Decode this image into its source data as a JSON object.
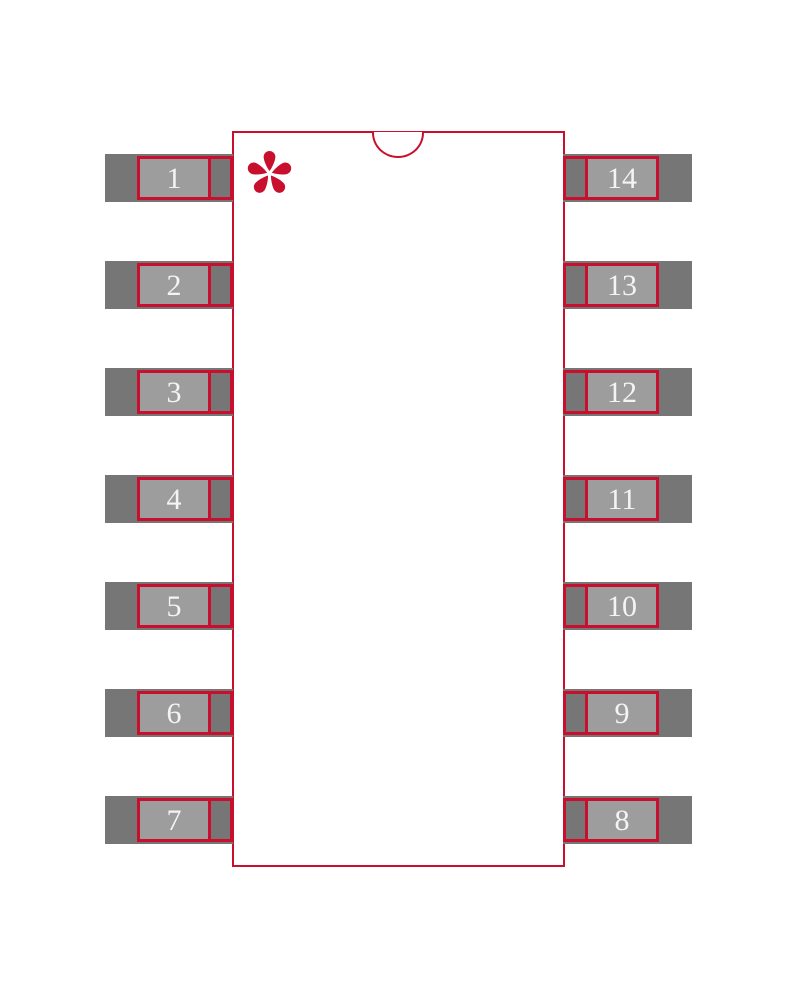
{
  "diagram": {
    "kind": "pcb-footprint-land-pattern",
    "package_style": "14-pin dual-row (SOIC-14)",
    "pin1_marker": "asterisk",
    "notch": "top-center semicircle"
  },
  "colors": {
    "accent_red": "#c8102e",
    "pad_dark": "#767676",
    "pad_light": "#9d9d9d",
    "background": "#ffffff",
    "pin_number_text": "#f4f4f4"
  },
  "pins": {
    "left": [
      "1",
      "2",
      "3",
      "4",
      "5",
      "6",
      "7"
    ],
    "right": [
      "14",
      "13",
      "12",
      "11",
      "10",
      "9",
      "8"
    ]
  }
}
